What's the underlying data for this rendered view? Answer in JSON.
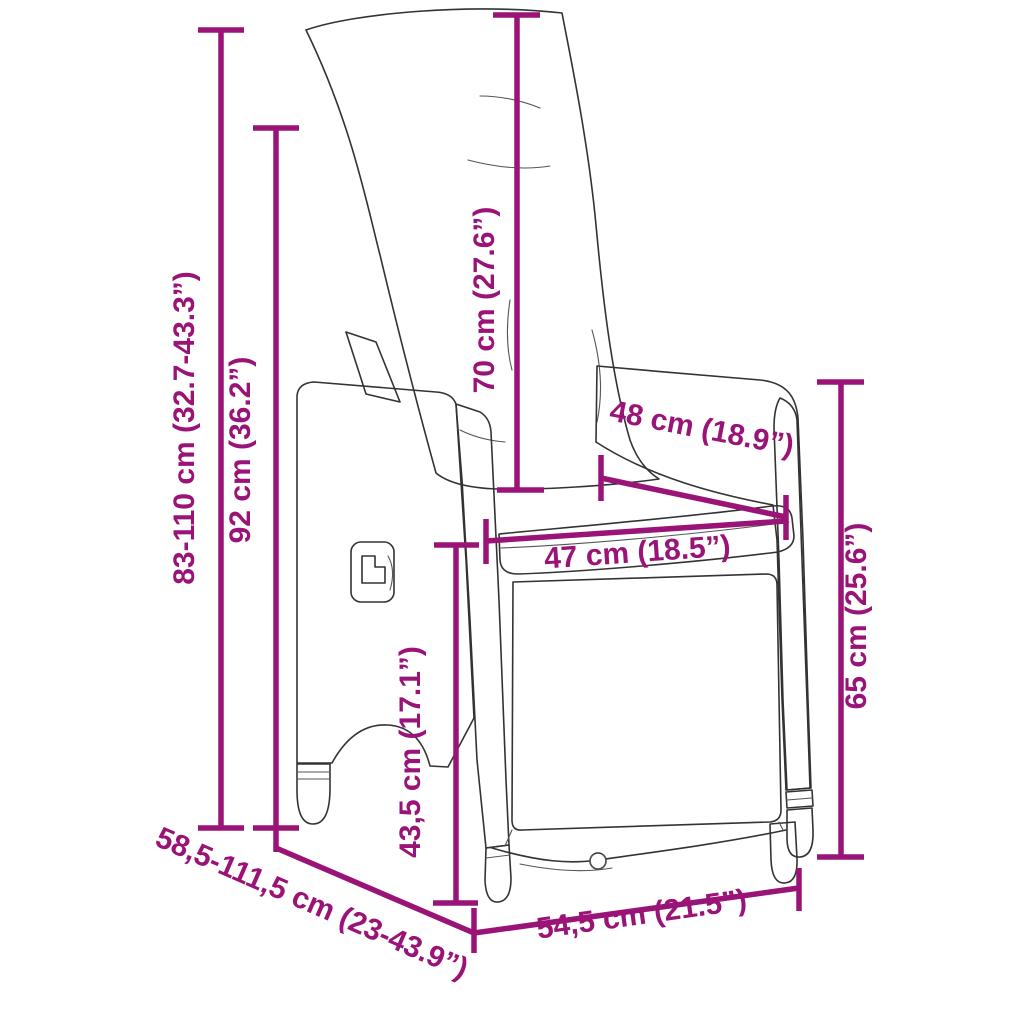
{
  "diagram": {
    "depicts": "reclining rattan garden chair with back and seat cushions, line drawing with measurements",
    "accent_color": "#9a1478",
    "outline_color": "#333333",
    "background_color": "#ffffff",
    "dimensions": [
      {
        "id": "far-left-vertical",
        "label": "83-110 cm (32.7-43.3”)"
      },
      {
        "id": "left-vertical",
        "label": "92 cm (36.2”)"
      },
      {
        "id": "backrest-vertical",
        "label": "70 cm (27.6”)"
      },
      {
        "id": "armrest-diagonal",
        "label": "48 cm (18.9”)"
      },
      {
        "id": "seat-width",
        "label": "47 cm (18.5”)"
      },
      {
        "id": "right-vertical",
        "label": "65 cm (25.6”)"
      },
      {
        "id": "front-vertical",
        "label": "43,5 cm (17.1”)"
      },
      {
        "id": "depth-diagonal",
        "label": "58,5-111,5 cm (23-43.9”)"
      },
      {
        "id": "bottom-width",
        "label": "54,5 cm (21.5”)"
      }
    ]
  }
}
